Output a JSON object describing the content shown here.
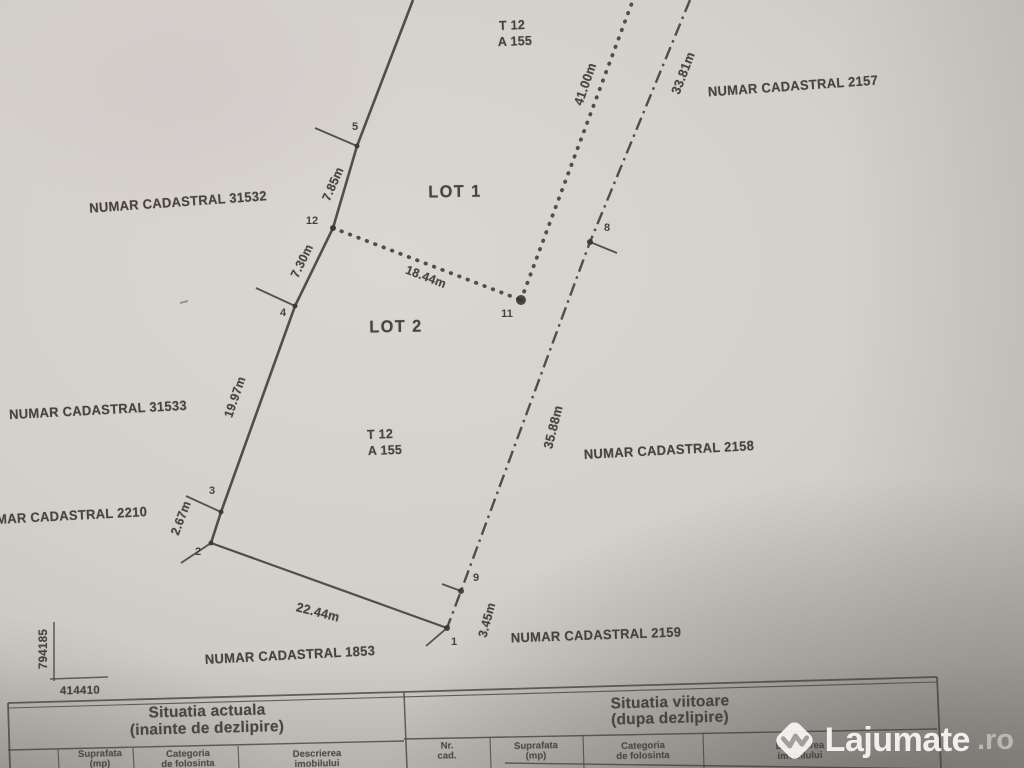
{
  "plan": {
    "labels": [
      {
        "id": "t12-top",
        "text": "T 12",
        "x": 512,
        "y": 25,
        "rot": -2,
        "size": 13
      },
      {
        "id": "a155-top",
        "text": "A 155",
        "x": 515,
        "y": 41,
        "rot": -2,
        "size": 13
      },
      {
        "id": "numar-cadastral-2157",
        "text": "NUMAR CADASTRAL 2157",
        "x": 793,
        "y": 86,
        "rot": -4,
        "size": 13.5
      },
      {
        "id": "dist-33-81",
        "text": "33.81m",
        "x": 683,
        "y": 73,
        "rot": -69,
        "size": 13
      },
      {
        "id": "dist-41-00",
        "text": "41.00m",
        "x": 585,
        "y": 84,
        "rot": -71,
        "size": 13
      },
      {
        "id": "numar-cadastral-31532",
        "text": "NUMAR CADASTRAL 31532",
        "x": 178,
        "y": 202,
        "rot": -4,
        "size": 13.5
      },
      {
        "id": "dist-7-85",
        "text": "7.85m",
        "x": 333,
        "y": 184,
        "rot": -66,
        "size": 12.5
      },
      {
        "id": "lot-1",
        "text": "LOT 1",
        "x": 455,
        "y": 192,
        "rot": -1,
        "size": 17,
        "ls": 1.5
      },
      {
        "id": "dist-7-30",
        "text": "7.30m",
        "x": 302,
        "y": 261,
        "rot": -64,
        "size": 12.5
      },
      {
        "id": "dist-18-44",
        "text": "18.44m",
        "x": 426,
        "y": 277,
        "rot": 21,
        "size": 12.5
      },
      {
        "id": "lot-2",
        "text": "LOT 2",
        "x": 396,
        "y": 327,
        "rot": -1,
        "size": 17,
        "ls": 1.5
      },
      {
        "id": "dist-19-97",
        "text": "19.97m",
        "x": 235,
        "y": 397,
        "rot": -71,
        "size": 12.5
      },
      {
        "id": "numar-cadastral-31533",
        "text": "NUMAR CADASTRAL 31533",
        "x": 98,
        "y": 410,
        "rot": -3,
        "size": 13.5
      },
      {
        "id": "numar-cadastral-2210",
        "text": "NUMAR CADASTRAL 2210",
        "x": 62,
        "y": 516,
        "rot": -3,
        "size": 13.5
      },
      {
        "id": "dist-2-67",
        "text": "2.67m",
        "x": 181,
        "y": 518,
        "rot": -69,
        "size": 12.5
      },
      {
        "id": "t12-mid",
        "text": "T 12",
        "x": 380,
        "y": 434,
        "rot": -2,
        "size": 13
      },
      {
        "id": "a155-mid",
        "text": "A 155",
        "x": 385,
        "y": 450,
        "rot": -2,
        "size": 13
      },
      {
        "id": "dist-35-88",
        "text": "35.88m",
        "x": 553,
        "y": 427,
        "rot": -76,
        "size": 13
      },
      {
        "id": "numar-cadastral-2158",
        "text": "NUMAR CADASTRAL 2158",
        "x": 669,
        "y": 450,
        "rot": -3,
        "size": 13.5
      },
      {
        "id": "dist-22-44",
        "text": "22.44m",
        "x": 318,
        "y": 612,
        "rot": 14,
        "size": 13
      },
      {
        "id": "numar-cadastral-1853",
        "text": "NUMAR CADASTRAL 1853",
        "x": 290,
        "y": 655,
        "rot": -3,
        "size": 13.5
      },
      {
        "id": "dist-3-45",
        "text": "3.45m",
        "x": 487,
        "y": 620,
        "rot": -75,
        "size": 12.5
      },
      {
        "id": "numar-cadastral-2159",
        "text": "NUMAR CADASTRAL 2159",
        "x": 596,
        "y": 635,
        "rot": -2,
        "size": 13.5
      }
    ],
    "points": [
      {
        "n": "1",
        "x": 447,
        "y": 628,
        "r": 3,
        "tick": [
          447,
          628,
          426,
          646
        ],
        "lx": 454,
        "ly": 642
      },
      {
        "n": "2",
        "x": 211,
        "y": 543,
        "r": 2.5,
        "tick": [
          211,
          543,
          181,
          563
        ],
        "lx": 198,
        "ly": 552
      },
      {
        "n": "3",
        "x": 221,
        "y": 512,
        "r": 2.5,
        "tick": [
          221,
          512,
          186,
          496
        ],
        "lx": 212,
        "ly": 491
      },
      {
        "n": "4",
        "x": 295,
        "y": 306,
        "r": 2.5,
        "tick": [
          295,
          306,
          256,
          288
        ],
        "lx": 283,
        "ly": 313
      },
      {
        "n": "5",
        "x": 357,
        "y": 146,
        "r": 2.5,
        "tick": [
          357,
          146,
          315,
          128
        ],
        "lx": 355,
        "ly": 127
      },
      {
        "n": "8",
        "x": 590,
        "y": 242,
        "r": 3,
        "tick": [
          590,
          242,
          617,
          253
        ],
        "lx": 607,
        "ly": 228
      },
      {
        "n": "9",
        "x": 461,
        "y": 591,
        "r": 3,
        "tick": [
          461,
          591,
          442,
          584
        ],
        "lx": 476,
        "ly": 578
      },
      {
        "n": "11",
        "x": 521,
        "y": 300,
        "r": 5,
        "lx": 507,
        "ly": 314
      },
      {
        "n": "12",
        "x": 333,
        "y": 228,
        "r": 3,
        "lx": 312,
        "ly": 221
      }
    ],
    "edges": [
      {
        "id": "boundary-west",
        "style": "solid",
        "w": 2.6,
        "pts": [
          [
            413,
            0
          ],
          [
            357,
            146
          ],
          [
            333,
            228
          ],
          [
            295,
            306
          ],
          [
            221,
            512
          ],
          [
            211,
            543
          ]
        ]
      },
      {
        "id": "boundary-south",
        "style": "solid",
        "w": 2.2,
        "pts": [
          [
            211,
            543
          ],
          [
            447,
            628
          ]
        ]
      },
      {
        "id": "boundary-east",
        "style": "dashdot",
        "w": 2.4,
        "pts": [
          [
            690,
            0
          ],
          [
            590,
            242
          ],
          [
            461,
            591
          ],
          [
            447,
            628
          ]
        ]
      },
      {
        "id": "lot-split-horizontal",
        "style": "dotted",
        "w": 3.8,
        "pts": [
          [
            333,
            228
          ],
          [
            521,
            300
          ]
        ]
      },
      {
        "id": "lot-split-vertical",
        "style": "dotted",
        "w": 3.8,
        "pts": [
          [
            521,
            300
          ],
          [
            633,
            0
          ]
        ]
      }
    ],
    "grid_mark": {
      "north_value": "794185",
      "east_value": "414410",
      "lines": [
        [
          54,
          622,
          54,
          681,
          1.6
        ],
        [
          50,
          679,
          108,
          677,
          1.6
        ]
      ]
    },
    "specks": [
      [
        180,
        303,
        188,
        301,
        1.8
      ]
    ]
  },
  "table": {
    "header_left_line1": "Situatia actuala",
    "header_left_line2": "(inainte de dezlipire)",
    "header_right_line1": "Situatia viitoare",
    "header_right_line2": "(dupa dezlipire)",
    "columns_left": [
      {
        "l1": "Suprafata",
        "l2": "(mp)",
        "x": 100
      },
      {
        "l1": "Categoria",
        "l2": "de folosinta",
        "x": 188
      },
      {
        "l1": "Descrierea",
        "l2": "imobilului",
        "x": 317
      }
    ],
    "columns_right": [
      {
        "l1": "Nr.",
        "l2": "cad.",
        "x": 447
      },
      {
        "l1": "Suprafata",
        "l2": "(mp)",
        "x": 536
      },
      {
        "l1": "Categoria",
        "l2": "de folosinta",
        "x": 643
      },
      {
        "l1": "Descrierea",
        "l2": "imobilului",
        "x": 800
      }
    ],
    "lines": [
      [
        8,
        703,
        937,
        677,
        1.8
      ],
      [
        8,
        708,
        937,
        682,
        1.1
      ],
      [
        8,
        703,
        10,
        768,
        1.8
      ],
      [
        937,
        677,
        941,
        768,
        1.8
      ],
      [
        404,
        692,
        407,
        768,
        1.5
      ],
      [
        8,
        750,
        404,
        741,
        1.4
      ],
      [
        404,
        739,
        937,
        729,
        1.4
      ],
      [
        505,
        763,
        1023,
        770,
        1.4
      ],
      [
        58,
        749,
        59,
        768,
        1.1
      ],
      [
        133,
        748,
        134,
        768,
        1.1
      ],
      [
        238,
        746,
        239,
        768,
        1.1
      ],
      [
        490,
        737,
        491,
        768,
        1.1
      ],
      [
        583,
        735,
        584,
        768,
        1.1
      ],
      [
        703,
        733,
        704,
        768,
        1.1
      ]
    ]
  },
  "watermark": {
    "brand": "Lajumate",
    "tld": ".ro",
    "logo": "lajumate-diamond-icon"
  }
}
